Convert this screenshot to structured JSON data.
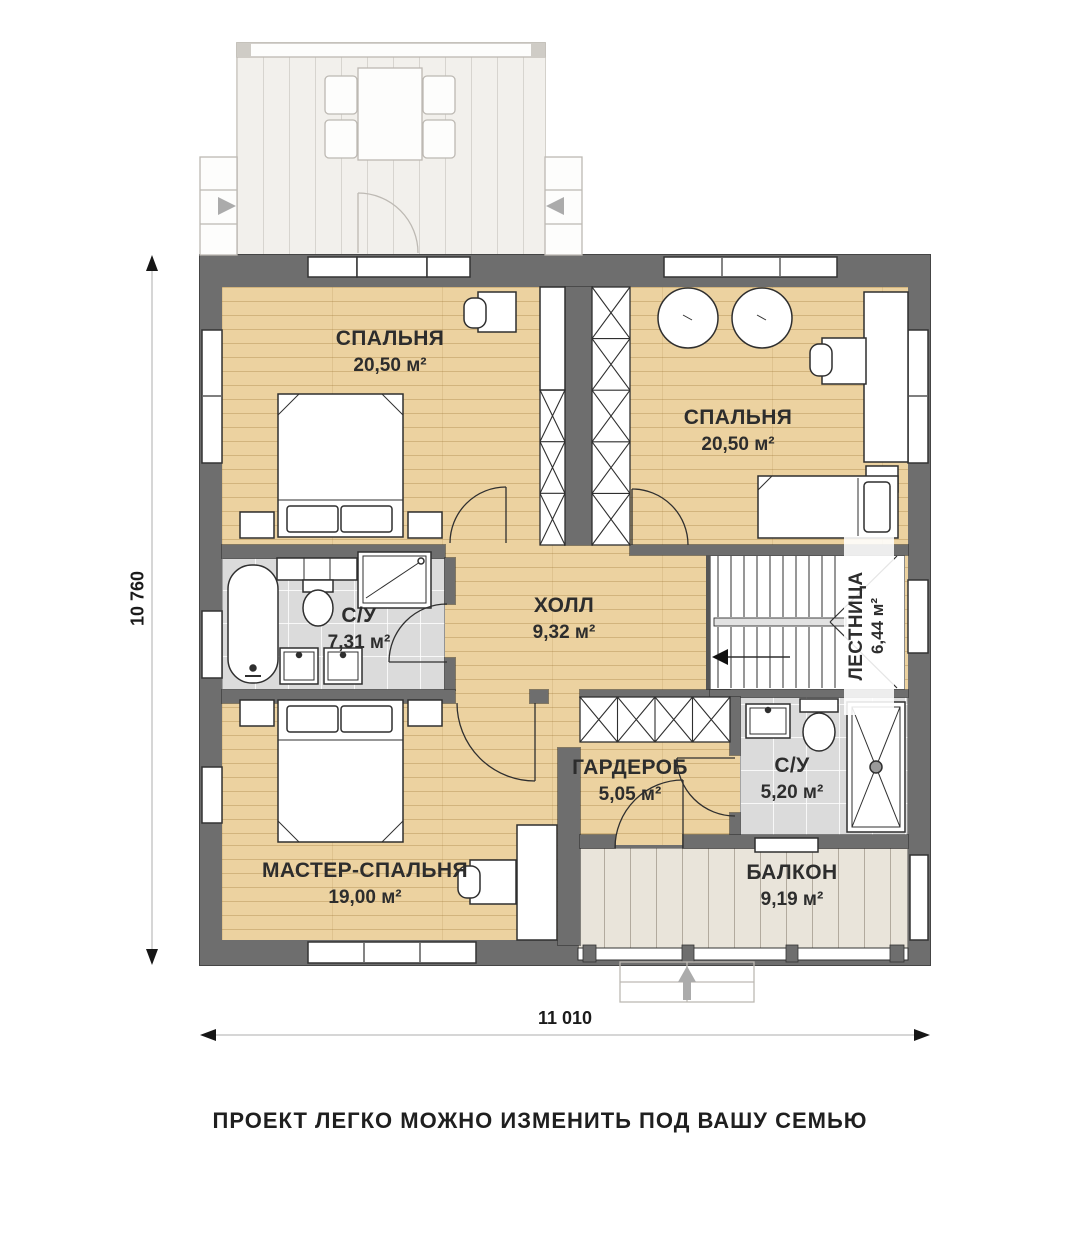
{
  "caption": "ПРОЕКТ ЛЕГКО МОЖНО ИЗМЕНИТЬ ПОД ВАШУ СЕМЬЮ",
  "dimensions": {
    "height": "10 760",
    "width": "11 010"
  },
  "rooms": {
    "bedroom_tl": {
      "name": "СПАЛЬНЯ",
      "area": "20,50 м²"
    },
    "bedroom_tr": {
      "name": "СПАЛЬНЯ",
      "area": "20,50 м²"
    },
    "hall": {
      "name": "ХОЛЛ",
      "area": "9,32 м²"
    },
    "bathroom_left": {
      "name": "С/У",
      "area": "7,31 м²"
    },
    "stairs": {
      "name": "ЛЕСТНИЦА",
      "area": "6,44 м²"
    },
    "wardrobe": {
      "name": "ГАРДЕРОБ",
      "area": "5,05 м²"
    },
    "bathroom_right": {
      "name": "С/У",
      "area": "5,20 м²"
    },
    "master_bedroom": {
      "name": "МАСТЕР-СПАЛЬНЯ",
      "area": "19,00 м²"
    },
    "balcony": {
      "name": "БАЛКОН",
      "area": "9,19 м²"
    }
  }
}
